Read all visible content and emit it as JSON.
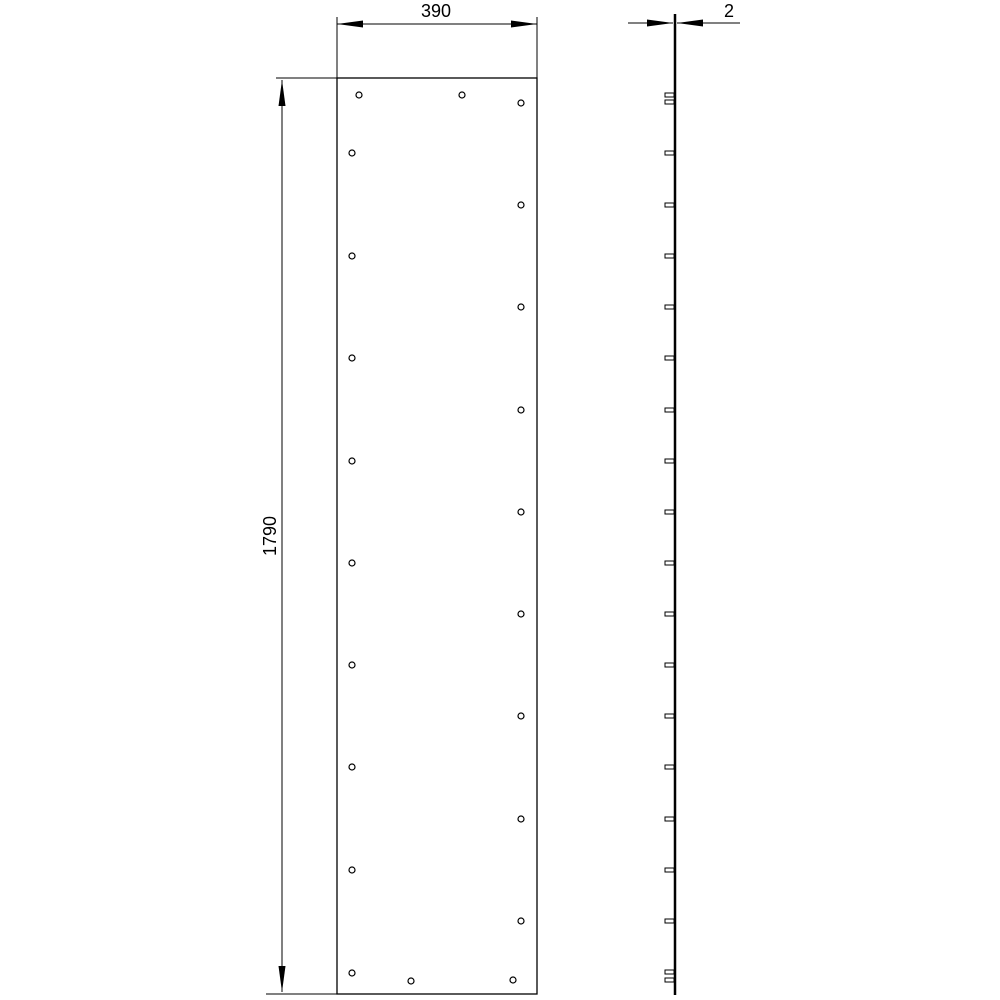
{
  "colors": {
    "background": "#ffffff",
    "line": "#000000"
  },
  "drawing": {
    "type": "technical-drawing",
    "views": {
      "front": {
        "name": "front-view-panel",
        "rect": {
          "x": 337,
          "y": 78,
          "width": 200,
          "height": 916
        },
        "outline_stroke": 1.3,
        "hole_radius": 3,
        "hole_stroke": 1.2,
        "holes": [
          {
            "x": 359,
            "y": 95
          },
          {
            "x": 462,
            "y": 95
          },
          {
            "x": 521,
            "y": 103
          },
          {
            "x": 352,
            "y": 153
          },
          {
            "x": 521,
            "y": 205
          },
          {
            "x": 352,
            "y": 256
          },
          {
            "x": 521,
            "y": 307
          },
          {
            "x": 352,
            "y": 358
          },
          {
            "x": 521,
            "y": 410
          },
          {
            "x": 352,
            "y": 461
          },
          {
            "x": 521,
            "y": 512
          },
          {
            "x": 352,
            "y": 563
          },
          {
            "x": 521,
            "y": 614
          },
          {
            "x": 352,
            "y": 665
          },
          {
            "x": 521,
            "y": 716
          },
          {
            "x": 352,
            "y": 767
          },
          {
            "x": 521,
            "y": 819
          },
          {
            "x": 352,
            "y": 870
          },
          {
            "x": 521,
            "y": 921
          },
          {
            "x": 352,
            "y": 973
          },
          {
            "x": 411,
            "y": 981
          },
          {
            "x": 513,
            "y": 980
          }
        ]
      },
      "side": {
        "name": "side-view-edge",
        "line": {
          "x": 675,
          "y1": 14,
          "y2": 995,
          "stroke_width": 2.5
        },
        "tick": {
          "width": 9,
          "height": 4,
          "stroke": 1
        },
        "tick_ys": [
          95,
          102,
          153,
          205,
          256,
          307,
          358,
          410,
          461,
          512,
          563,
          614,
          665,
          716,
          767,
          819,
          870,
          921,
          972,
          980
        ]
      }
    },
    "dimension_style": {
      "stroke": 1,
      "arrow_length": 26,
      "arrow_half_width": 3.5,
      "font_size": 18
    },
    "dimensions": [
      {
        "name": "width",
        "value": "390",
        "label_pos": {
          "x": 436,
          "y": 17,
          "rotate": 0
        },
        "lines": [
          {
            "x1": 337,
            "y1": 17,
            "x2": 337,
            "y2": 78
          },
          {
            "x1": 537,
            "y1": 17,
            "x2": 537,
            "y2": 78
          },
          {
            "x1": 337,
            "y1": 24,
            "x2": 537,
            "y2": 24
          }
        ],
        "arrows": [
          {
            "x": 337,
            "y": 24,
            "dir": "left"
          },
          {
            "x": 537,
            "y": 24,
            "dir": "right"
          }
        ]
      },
      {
        "name": "height",
        "value": "1790",
        "label_pos": {
          "x": 276,
          "y": 536,
          "rotate": -90
        },
        "lines": [
          {
            "x1": 276,
            "y1": 78,
            "x2": 338,
            "y2": 78
          },
          {
            "x1": 266,
            "y1": 994,
            "x2": 338,
            "y2": 994
          },
          {
            "x1": 282,
            "y1": 80,
            "x2": 282,
            "y2": 992
          }
        ],
        "arrows": [
          {
            "x": 282,
            "y": 80,
            "dir": "up"
          },
          {
            "x": 282,
            "y": 992,
            "dir": "down"
          }
        ]
      },
      {
        "name": "thickness",
        "value": "2",
        "label_pos": {
          "x": 729,
          "y": 17,
          "rotate": 0
        },
        "lines": [
          {
            "x1": 628,
            "y1": 23,
            "x2": 673,
            "y2": 23
          },
          {
            "x1": 677,
            "y1": 23,
            "x2": 740,
            "y2": 23
          }
        ],
        "arrows": [
          {
            "x": 673,
            "y": 23,
            "dir": "right"
          },
          {
            "x": 677,
            "y": 23,
            "dir": "left"
          }
        ]
      }
    ]
  }
}
